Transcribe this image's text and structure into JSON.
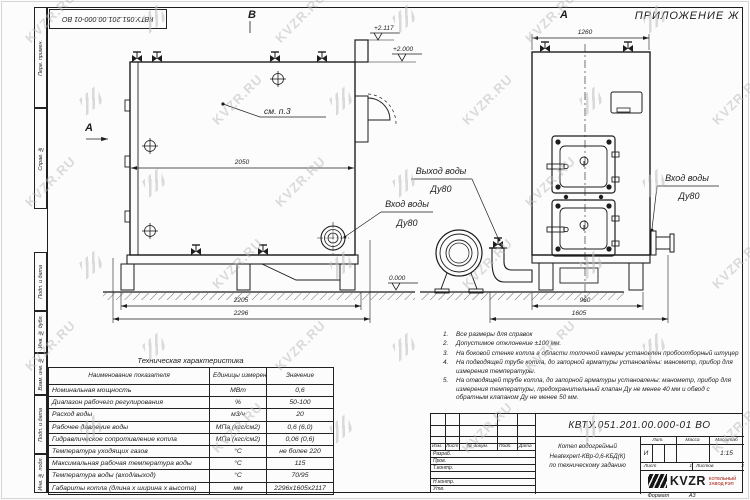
{
  "watermark": {
    "text": "KVZR.RU"
  },
  "doc_number": "КВТУ.051.201.00.000-01 ВО",
  "frame": {
    "appendix": "ПРИЛОЖЕНИЕ Ж",
    "format_label": "Формат",
    "format_value": "А3",
    "margin_labels": [
      "Перв. примен.",
      "Справ. №",
      "Подп. и дата",
      "Инв. № дубл.",
      "Взам. инв. №",
      "Подп. и дата",
      "Инв. № подл."
    ]
  },
  "views": {
    "marks": {
      "section_a": "А",
      "section_b": "В",
      "view_a": "А",
      "see_note": "см. п.3"
    },
    "elevations": {
      "chimney": "+2.117",
      "boiler_top": "+2.000",
      "ground": "0.000"
    },
    "dimensions": {
      "side_width": "2050",
      "side_base": "2205",
      "side_total": "2296",
      "front_top": "1260",
      "front_base": "960",
      "front_total": "1605"
    },
    "labels": {
      "outlet_line1": "Выход воды",
      "outlet_line2": "Ду80",
      "inlet_side_line1": "Вход воды",
      "inlet_side_line2": "Ду80",
      "inlet_front_line1": "Вход воды",
      "inlet_front_line2": "Ду80"
    }
  },
  "notes": {
    "items": [
      "Все размеры для справок",
      "Допустимое отклонение ±100 мм.",
      "На боковой стенке котла в области топочной камеры установлен пробоотборный штуцер",
      "На подводящей трубе котла, до запорной арматуры установлены: манометр, прибор для измерения температуры.",
      "На отводящей трубе котла, до запорной арматуры установлены: манометр, прибор для измерения температуры, предохранительный клапан Ду не менее 40 мм и обвод с обратным клапаном Ду не менее 50 мм."
    ]
  },
  "tech_table": {
    "title": "Техническая характеристика",
    "headers": [
      "Наименование показателя",
      "Единицы измерения",
      "Значение"
    ],
    "rows": [
      [
        "Номинальная мощность",
        "МВт",
        "0,6"
      ],
      [
        "Диапазон рабочего регулирования",
        "%",
        "50-100"
      ],
      [
        "Расход воды",
        "м3/ч",
        "20"
      ],
      [
        "Рабочее давление воды",
        "МПа (кгс/см2)",
        "0,6 (6,0)"
      ],
      [
        "Гидравлическое сопротивление котла",
        "МПа (кгс/см2)",
        "0,06 (0,6)"
      ],
      [
        "Температура уходящих газов",
        "°С",
        "не более 220"
      ],
      [
        "Максимальная рабочая температура воды",
        "°С",
        "115"
      ],
      [
        "Температура воды (вход/выход)",
        "°С",
        "70/95"
      ],
      [
        "Габариты котла (длина х ширина х высота)",
        "мм",
        "2296х1605х2117"
      ]
    ]
  },
  "title_block": {
    "product_line1": "Котел водогрейный",
    "product_line2": "Heatexpert-КВр-0,6-КБД(К)",
    "product_line3": "по техническому заданию",
    "col_izm": "Изм.",
    "col_list": "Лист",
    "col_doc": "№ докум.",
    "col_sign": "Подп.",
    "col_date": "Дата",
    "role_1": "Разраб.",
    "role_2": "Пров.",
    "role_3": "Т.контр.",
    "role_4": "Н.контр.",
    "role_5": "Утв.",
    "lit_label": "Лит.",
    "lit_value": "И",
    "mass_label": "Масса",
    "scale_label": "Масштаб",
    "scale_value": "1:15",
    "sheet_label": "Лист",
    "sheet_value": "1",
    "sheets_label": "Листов",
    "sheets_value": "2",
    "logo_text": "KVZR",
    "logo_sub1": "КОТЕЛЬНЫЙ",
    "logo_sub2": "ЗАВОД РЭП"
  }
}
